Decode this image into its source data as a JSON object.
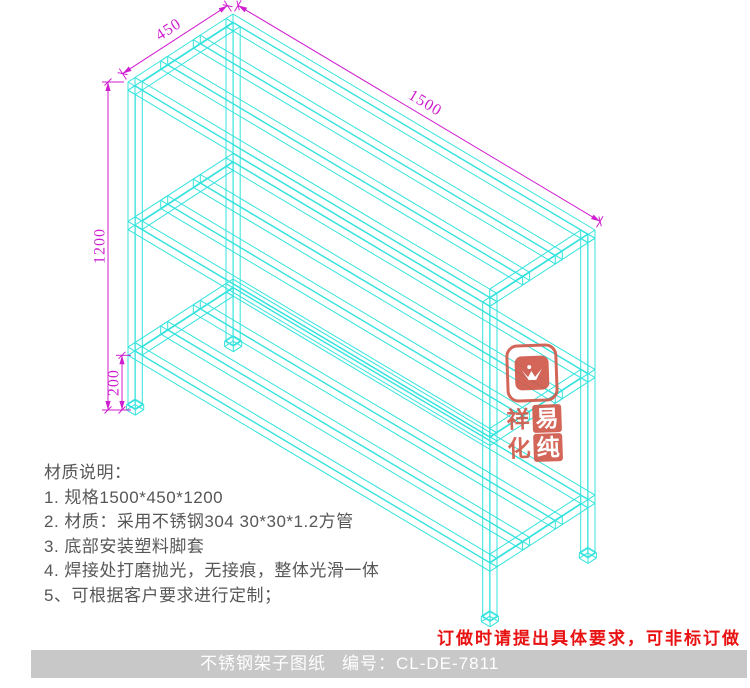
{
  "drawing": {
    "colors": {
      "wireframe": "#35e3dd",
      "dimension": "#cf1ecf",
      "note_text": "#575757",
      "order_note": "#e81212",
      "footer_bg": "#c8c8c8",
      "footer_text": "#ffffff",
      "seal": "#d05a4c"
    },
    "proj": {
      "ox": 233,
      "oy": 14,
      "lx": 0.2413,
      "ly": 0.144,
      "dx": -0.2333,
      "dy": 0.1511,
      "hz": 0.2733
    },
    "rack": {
      "length_mm": 1500,
      "depth_mm": 450,
      "height_mm": 1200,
      "tube_mm": 30,
      "foot_mm": 20,
      "bottom_clearance_mm": 200,
      "shelf_top_mm": [
        1200,
        690,
        230
      ],
      "slat_y_mm": [
        140,
        280
      ]
    },
    "dim_labels": {
      "depth": "450",
      "length": "1500",
      "height": "1200",
      "clearance": "200"
    }
  },
  "notes": {
    "title": "材质说明：",
    "items": [
      "1. 规格1500*450*1200",
      "2. 材质：采用不锈钢304  30*30*1.2方管",
      "3. 底部安装塑料脚套",
      "4. 焊接处打磨抛光，无接痕，整体光滑一体",
      "5、可根据客户要求进行定制；"
    ]
  },
  "order_note": "订做时请提出具体要求，可非标订做",
  "footer": {
    "title": "不锈钢架子图纸",
    "code_label": "编号：",
    "code": "CL-DE-7811"
  },
  "seal": {
    "chars": [
      "祥",
      "易",
      "化",
      "纯"
    ]
  }
}
